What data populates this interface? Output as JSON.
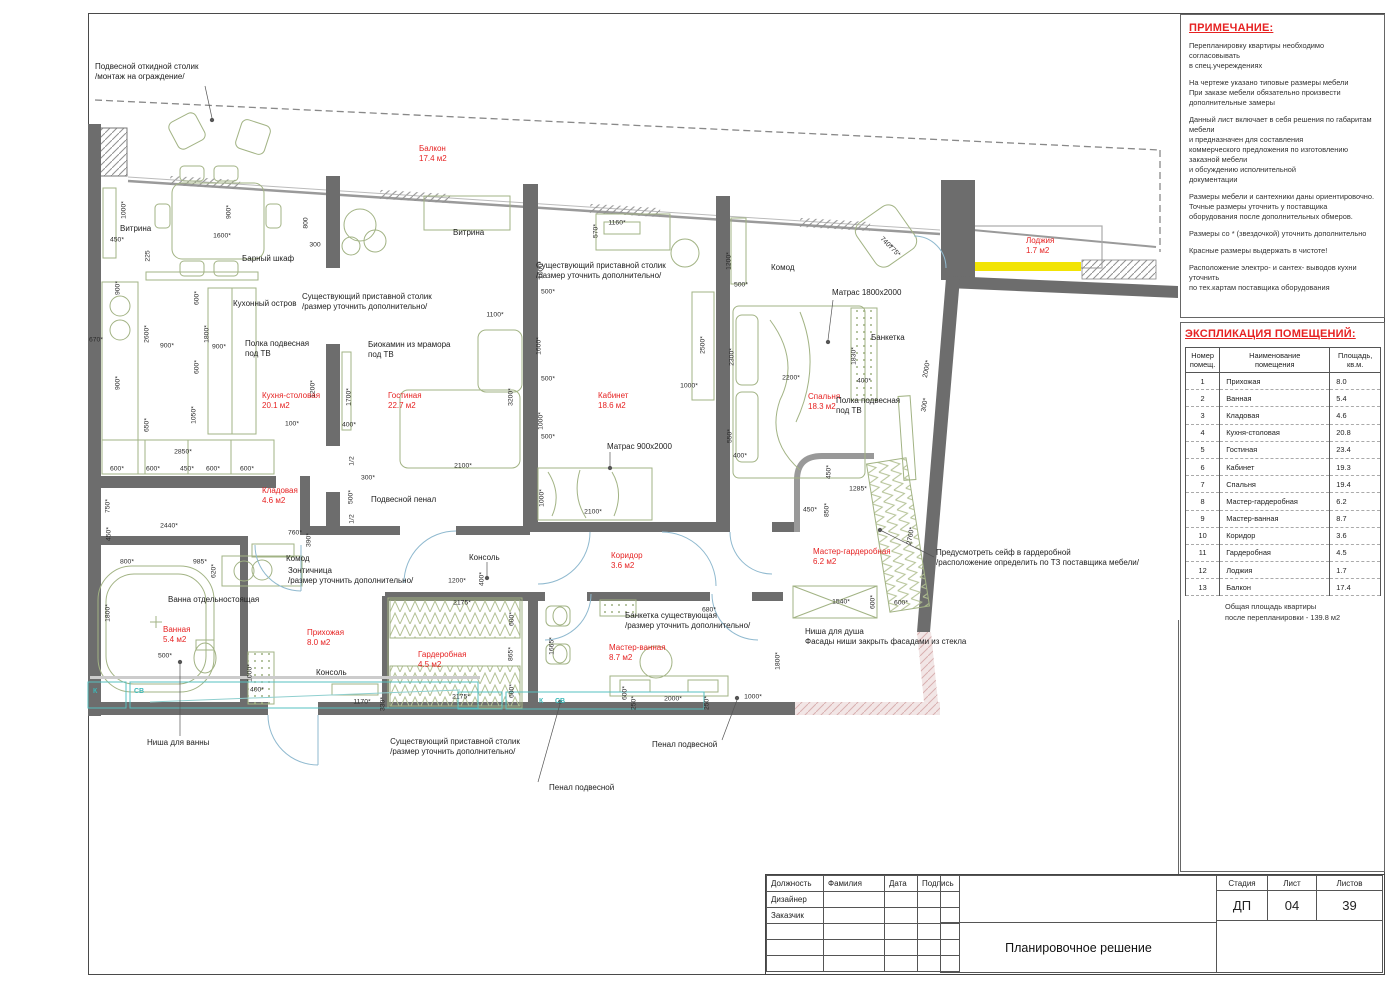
{
  "notes_panel": {
    "title": "ПРИМЕЧАНИЕ:",
    "paragraphs": [
      "Перепланировку квартиры необходимо согласовывать\nв спец.учереждениях",
      "На чертеже указано типовые размеры мебели\nПри заказе мебели обязательно произвести\nдополнительные замеры",
      "Данный лист включает в себя решения по габаритам мебели\nи предназначен для составления\nкоммерческого предложения по изготовлению заказной мебели\nи обсуждению исполнительной\nдокументации",
      "Размеры мебели и сантехники даны ориентировочно.\nТочные размеры уточнить у поставщика\nоборудования после дополнительных обмеров.",
      "Размеры со * (звездочкой) уточнить дополнительно",
      "Красные размеры выдержать в чистоте!",
      "Расположение электро- и сантех- выводов кухни уточнить\nпо тех.картам поставщика оборудования"
    ]
  },
  "explication": {
    "title": "ЭКСПЛИКАЦИЯ ПОМЕЩЕНИЙ:",
    "headers": {
      "num": "Номер\nпомещ.",
      "name": "Наименование\nпомещения",
      "area": "Площадь,\nкв.м."
    },
    "rows": [
      [
        "1",
        "Прихожая",
        "8.0"
      ],
      [
        "2",
        "Ванная",
        "5.4"
      ],
      [
        "3",
        "Кладовая",
        "4.6"
      ],
      [
        "4",
        "Кухня-столовая",
        "20.8"
      ],
      [
        "5",
        "Гостиная",
        "23.4"
      ],
      [
        "6",
        "Кабинет",
        "19.3"
      ],
      [
        "7",
        "Спальня",
        "19.4"
      ],
      [
        "8",
        "Мастер-гардеробная",
        "6.2"
      ],
      [
        "9",
        "Мастер-ванная",
        "8.7"
      ],
      [
        "10",
        "Коридор",
        "3.6"
      ],
      [
        "11",
        "Гардеробная",
        "4.5"
      ],
      [
        "12",
        "Лоджия",
        "1.7"
      ],
      [
        "13",
        "Балкон",
        "17.4"
      ]
    ],
    "total": "Общая площадь квартиры\nпосле перепланировки - 139.8 м2"
  },
  "title_block": {
    "columns": [
      "Должность",
      "Фамилия",
      "Дата",
      "Подпись"
    ],
    "left_rows": [
      "Дизайнер",
      "Заказчик",
      "",
      "",
      ""
    ],
    "doc_title": "Планировочное решение",
    "stage_label": "Стадия",
    "sheet_label": "Лист",
    "sheets_label": "Листов",
    "stage": "ДП",
    "sheet": "04",
    "sheets": "39"
  },
  "plan": {
    "accent_red": "#e62222",
    "wall_gray": "#6d6d6d",
    "loggia_yellow": "#f2e405",
    "furniture_olive": "#a2b384",
    "rooms": [
      {
        "n": "Балкон",
        "a": "17.4 м2",
        "x": 419,
        "y": 144
      },
      {
        "n": "Кухня-столовая",
        "a": "20.1 м2",
        "x": 262,
        "y": 391
      },
      {
        "n": "Гостиная",
        "a": "22.7 м2",
        "x": 388,
        "y": 391
      },
      {
        "n": "Кабинет",
        "a": "18.6 м2",
        "x": 598,
        "y": 391
      },
      {
        "n": "Спальня",
        "a": "18.3 м2",
        "x": 808,
        "y": 392
      },
      {
        "n": "Лоджия",
        "a": "1.7 м2",
        "x": 1026,
        "y": 236
      },
      {
        "n": "Кладовая",
        "a": "4.6 м2",
        "x": 262,
        "y": 486
      },
      {
        "n": "Ванная",
        "a": "5.4 м2",
        "x": 163,
        "y": 625
      },
      {
        "n": "Прихожая",
        "a": "8.0 м2",
        "x": 307,
        "y": 628
      },
      {
        "n": "Гардеробная",
        "a": "4.5 м2",
        "x": 418,
        "y": 650
      },
      {
        "n": "Коридор",
        "a": "3.6 м2",
        "x": 611,
        "y": 551
      },
      {
        "n": "Мастер-ванная",
        "a": "8.7 м2",
        "x": 609,
        "y": 643
      },
      {
        "n": "Мастер-гардеробная",
        "a": "6.2 м2",
        "x": 813,
        "y": 547
      }
    ],
    "annotations": [
      {
        "t": "Подвесной откидной столик\n/монтаж на ограждение/",
        "x": 95,
        "y": 62
      },
      {
        "t": "Витрина",
        "x": 120,
        "y": 224
      },
      {
        "t": "Барный шкаф",
        "x": 242,
        "y": 254
      },
      {
        "t": "Кухонный остров",
        "x": 233,
        "y": 299
      },
      {
        "t": "Существующий приставной столик\n/размер уточнить дополнительно/",
        "x": 302,
        "y": 292
      },
      {
        "t": "Полка подвесная\nпод ТВ",
        "x": 245,
        "y": 339
      },
      {
        "t": "Биокамин из мрамора\nпод ТВ",
        "x": 368,
        "y": 340
      },
      {
        "t": "Витрина",
        "x": 453,
        "y": 228
      },
      {
        "t": "Существующий приставной столик\n/размер уточнить дополнительно/",
        "x": 536,
        "y": 261
      },
      {
        "t": "Матрас 900х2000",
        "x": 607,
        "y": 442
      },
      {
        "t": "Комод",
        "x": 771,
        "y": 263
      },
      {
        "t": "Матрас 1800х2000",
        "x": 832,
        "y": 288
      },
      {
        "t": "Банкетка",
        "x": 871,
        "y": 333
      },
      {
        "t": "Полка подвесная\nпод ТВ",
        "x": 836,
        "y": 396
      },
      {
        "t": "Предусмотреть сейф в гардеробной\n/расположение определить по ТЗ поставщика мебели/",
        "x": 936,
        "y": 548
      },
      {
        "t": "Ниша для душа\nФасады ниши закрыть фасадами из стекла",
        "x": 805,
        "y": 627
      },
      {
        "t": "Комод",
        "x": 286,
        "y": 554
      },
      {
        "t": "Зонтичница\n/размер уточнить дополнительно/",
        "x": 288,
        "y": 566
      },
      {
        "t": "Ванна отдельностоящая",
        "x": 168,
        "y": 595
      },
      {
        "t": "Консоль",
        "x": 316,
        "y": 668
      },
      {
        "t": "Консоль",
        "x": 469,
        "y": 553
      },
      {
        "t": "Банкетка существующая\n/размер уточнить дополнительно/",
        "x": 625,
        "y": 611
      },
      {
        "t": "Существующий приставной столик\n/размер уточнить дополнительно/",
        "x": 455,
        "y": 737,
        "al": "c"
      },
      {
        "t": "Пенал подвесной",
        "x": 652,
        "y": 740
      },
      {
        "t": "Пенал подвесной",
        "x": 549,
        "y": 783
      },
      {
        "t": "Ниша для ванны",
        "x": 147,
        "y": 738
      },
      {
        "t": "Подвесной пенал",
        "x": 371,
        "y": 495
      }
    ],
    "dims": [
      [
        "450*",
        117,
        240,
        0
      ],
      [
        "1000*",
        124,
        210,
        -90
      ],
      [
        "1600*",
        222,
        236,
        0
      ],
      [
        "900*",
        229,
        212,
        -90
      ],
      [
        "800",
        306,
        223,
        -90
      ],
      [
        "300",
        315,
        245,
        0
      ],
      [
        "225",
        148,
        256,
        -90
      ],
      [
        "900*",
        118,
        288,
        -90
      ],
      [
        "600*",
        197,
        298,
        -90
      ],
      [
        "670*",
        96,
        340,
        0
      ],
      [
        "2600*",
        147,
        334,
        -90
      ],
      [
        "900*",
        167,
        346,
        0
      ],
      [
        "1800*",
        207,
        334,
        -90
      ],
      [
        "900*",
        219,
        347,
        0
      ],
      [
        "600*",
        197,
        367,
        -90
      ],
      [
        "900*",
        118,
        383,
        -90
      ],
      [
        "650*",
        147,
        425,
        -90
      ],
      [
        "1050*",
        194,
        415,
        -90
      ],
      [
        "2850*",
        183,
        452,
        0
      ],
      [
        "450*",
        187,
        469,
        0
      ],
      [
        "600*",
        117,
        469,
        0
      ],
      [
        "600*",
        153,
        469,
        0
      ],
      [
        "600*",
        213,
        469,
        0
      ],
      [
        "600*",
        247,
        469,
        0
      ],
      [
        "750*",
        108,
        506,
        -90
      ],
      [
        "1200*",
        313,
        389,
        -90
      ],
      [
        "100*",
        292,
        424,
        0
      ],
      [
        "400*",
        349,
        425,
        0
      ],
      [
        "1700*",
        349,
        397,
        -90
      ],
      [
        "1/2",
        352,
        461,
        -90
      ],
      [
        "300*",
        368,
        478,
        0
      ],
      [
        "500*",
        351,
        497,
        -90
      ],
      [
        "1/2",
        352,
        519,
        -90
      ],
      [
        "3200*",
        511,
        397,
        -90
      ],
      [
        "2100*",
        463,
        466,
        0
      ],
      [
        "1100*",
        495,
        315,
        0
      ],
      [
        "1160*",
        617,
        223,
        0
      ],
      [
        "570*",
        596,
        231,
        -90
      ],
      [
        "1000*",
        541,
        270,
        -90
      ],
      [
        "500*",
        548,
        292,
        0
      ],
      [
        "1600*",
        539,
        346,
        -90
      ],
      [
        "500*",
        548,
        379,
        0
      ],
      [
        "1000*",
        541,
        421,
        -90
      ],
      [
        "500*",
        548,
        437,
        0
      ],
      [
        "1000*",
        542,
        498,
        -90
      ],
      [
        "2100*",
        593,
        512,
        0
      ],
      [
        "1200*",
        729,
        261,
        -90
      ],
      [
        "500*",
        741,
        285,
        0
      ],
      [
        "2500*",
        703,
        345,
        -90
      ],
      [
        "1000*",
        689,
        386,
        0
      ],
      [
        "2300*",
        732,
        357,
        -90
      ],
      [
        "550*",
        730,
        436,
        -90
      ],
      [
        "400*",
        740,
        456,
        0
      ],
      [
        "2200*",
        791,
        378,
        0
      ],
      [
        "1830*",
        854,
        356,
        -90
      ],
      [
        "400*",
        864,
        381,
        0
      ],
      [
        "2000*",
        927,
        369,
        -80
      ],
      [
        "300*",
        925,
        405,
        -80
      ],
      [
        "740*",
        886,
        243,
        45
      ],
      [
        "775*",
        894,
        251,
        45
      ],
      [
        "450*",
        829,
        472,
        -90
      ],
      [
        "1285*",
        858,
        489,
        0
      ],
      [
        "450*",
        810,
        510,
        0
      ],
      [
        "850*",
        827,
        510,
        -90
      ],
      [
        "2760*",
        911,
        536,
        -80
      ],
      [
        "1540*",
        841,
        602,
        0
      ],
      [
        "600*",
        873,
        602,
        -90
      ],
      [
        "600*",
        901,
        603,
        0
      ],
      [
        "1800*",
        778,
        661,
        -90
      ],
      [
        "2440*",
        169,
        526,
        0
      ],
      [
        "450*",
        109,
        534,
        -90
      ],
      [
        "760*",
        295,
        533,
        0
      ],
      [
        "390*",
        309,
        540,
        -90
      ],
      [
        "800*",
        127,
        562,
        0
      ],
      [
        "985*",
        200,
        562,
        0
      ],
      [
        "620*",
        214,
        571,
        -90
      ],
      [
        "1800*",
        108,
        613,
        -90
      ],
      [
        "500*",
        165,
        656,
        0
      ],
      [
        "1000*",
        250,
        673,
        -90
      ],
      [
        "400*",
        257,
        690,
        0
      ],
      [
        "1170*",
        362,
        702,
        0
      ],
      [
        "330*",
        383,
        704,
        -90
      ],
      [
        "1200*",
        457,
        581,
        0
      ],
      [
        "400*",
        482,
        579,
        -90
      ],
      [
        "2175*",
        462,
        603,
        0
      ],
      [
        "600*",
        512,
        619,
        -90
      ],
      [
        "865*",
        511,
        654,
        -90
      ],
      [
        "600*",
        512,
        691,
        -90
      ],
      [
        "2175*",
        461,
        697,
        0
      ],
      [
        "1665*",
        552,
        646,
        -90
      ],
      [
        "680*",
        709,
        610,
        0
      ],
      [
        "600*",
        625,
        693,
        -90
      ],
      [
        "250*",
        634,
        703,
        -90
      ],
      [
        "2000*",
        673,
        699,
        0
      ],
      [
        "250*",
        707,
        703,
        -90
      ],
      [
        "1000*",
        753,
        697,
        0
      ]
    ],
    "utility": [
      [
        "К",
        93,
        688
      ],
      [
        "СВ",
        134,
        688
      ],
      [
        "К",
        539,
        698
      ],
      [
        "СВ",
        555,
        698
      ]
    ]
  }
}
